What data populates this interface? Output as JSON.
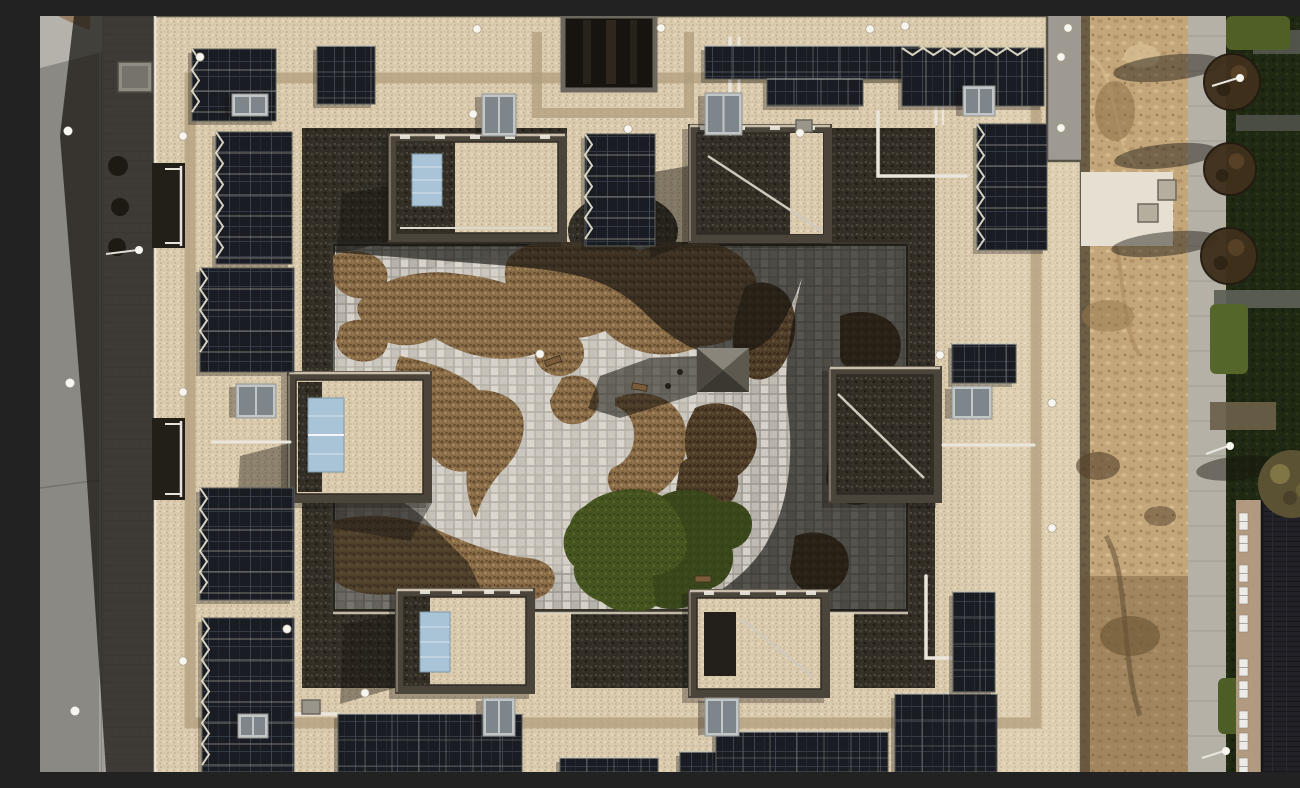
{
  "meta": {
    "title": "Aerial drone photograph — courtyard apartment block rooftop",
    "type": "top-down aerial photograph",
    "caption": "Top-down drone view of a large square courtyard apartment building: light gravel flat roof with many dark photovoltaic arrays, six stair/penthouse towers (some with light-blue solar-thermal collectors), skylights, white fall-protection anchors and pipework; landscaped inner courtyard with grey cobble paving, organic brown planting beds, a pyramid-roofed pavilion and a green turf patch; street with sidewalk on the left in building shadow; bare construction dirt strip, concrete pad, paver footpath, pruned trees, lawn with paved strips and a neighbouring dark pitched-roof house with white windows on the right."
  },
  "palette": {
    "road": "#8b8984",
    "sidewalk": "#a6a39d",
    "shadow": "#16140f",
    "facade": "#f0e9da",
    "roofGravel": "#dbcbae",
    "roofBright": "#f2e7cd",
    "walkway": "#b09e7e",
    "parapet": "#4a443a",
    "sedum": "#322e26",
    "panel": "#191c22",
    "panelLine": "#3c434e",
    "panelFrame": "#5a5c58",
    "skyFrame": "#c3c6c6",
    "skyGlass": "#7f868b",
    "collector": "#a9c4d6",
    "courtPaving": "#c9c5bd",
    "pavingGap": "#9d9991",
    "shrub": "#876a46",
    "shrubDark": "#4e3d28",
    "turf": "#46551f",
    "turfDark": "#303d16",
    "dirt": "#c3a67a",
    "dirtDark": "#97794e",
    "path": "#b6b1a7",
    "grassDark": "#1f2812",
    "grassLight": "#4f5f26",
    "treeBrown": "#3f301c",
    "roofTiles": "#222127",
    "wallTan": "#b19a80",
    "windowWhite": "#ecebe7",
    "pipe": "#eae6dc",
    "dot": "#f7f5ef",
    "pavilionLight": "#8a857a",
    "pavilionDark": "#3b3831",
    "concretePad": "#e7e0d2"
  },
  "scene": {
    "inventory": {
      "solar_pv_arrays": 18,
      "stair_towers": 6,
      "solar_thermal_collectors": 3,
      "skylights": 9,
      "roof_anchor_points": 20,
      "planting_beds": 16,
      "courtyard_pavilions": 1,
      "turf_patches": 1,
      "street_trees_right": 3,
      "street_lamps": 7,
      "neighbouring_buildings": 1,
      "balcony_recesses_left": 2
    },
    "anchor_dots": [
      [
        437,
        13
      ],
      [
        621,
        12
      ],
      [
        830,
        13
      ],
      [
        865,
        10
      ],
      [
        1028,
        12
      ],
      [
        160,
        41
      ],
      [
        1021,
        41
      ],
      [
        433,
        98
      ],
      [
        588,
        113
      ],
      [
        760,
        117
      ],
      [
        1021,
        112
      ],
      [
        900,
        339
      ],
      [
        1012,
        387
      ],
      [
        1012,
        512
      ],
      [
        143,
        376
      ],
      [
        143,
        120
      ],
      [
        143,
        645
      ],
      [
        247,
        613
      ],
      [
        325,
        677
      ],
      [
        500,
        338
      ]
    ],
    "skylights": [
      [
        192,
        78,
        36,
        22
      ],
      [
        442,
        78,
        34,
        42
      ],
      [
        665,
        77,
        37,
        42
      ],
      [
        923,
        70,
        32,
        30
      ],
      [
        196,
        368,
        40,
        34
      ],
      [
        912,
        370,
        40,
        33
      ],
      [
        443,
        682,
        32,
        38
      ],
      [
        665,
        682,
        34,
        38
      ],
      [
        198,
        698,
        30,
        24
      ]
    ],
    "solar_arrays": [
      [
        152,
        33,
        84,
        72,
        "tiltv"
      ],
      [
        277,
        30,
        58,
        58,
        "flat"
      ],
      [
        545,
        118,
        70,
        112,
        "tiltv"
      ],
      [
        665,
        30,
        214,
        33,
        "flat"
      ],
      [
        727,
        63,
        96,
        27,
        "flat"
      ],
      [
        862,
        32,
        142,
        58,
        "tilth"
      ],
      [
        937,
        108,
        70,
        126,
        "tiltv"
      ],
      [
        176,
        116,
        76,
        132,
        "tiltv"
      ],
      [
        160,
        252,
        94,
        104,
        "tiltv"
      ],
      [
        160,
        472,
        94,
        112,
        "tiltv"
      ],
      [
        162,
        602,
        92,
        154,
        "tiltv"
      ],
      [
        298,
        698,
        184,
        58,
        "flat"
      ],
      [
        640,
        736,
        102,
        20,
        "flat"
      ],
      [
        676,
        716,
        172,
        40,
        "flat"
      ],
      [
        855,
        678,
        102,
        78,
        "flat"
      ],
      [
        913,
        576,
        42,
        100,
        "flat"
      ],
      [
        912,
        328,
        64,
        39,
        "flat"
      ],
      [
        520,
        742,
        98,
        14,
        "flat"
      ]
    ],
    "towers": [
      [
        348,
        117,
        179,
        109,
        "mixed"
      ],
      [
        648,
        108,
        144,
        119,
        "sedum"
      ],
      [
        247,
        355,
        145,
        132,
        "gravel"
      ],
      [
        788,
        350,
        114,
        137,
        "sedum"
      ],
      [
        355,
        572,
        140,
        106,
        "gravel"
      ],
      [
        648,
        573,
        142,
        109,
        "gravel"
      ]
    ],
    "trees_right": [
      [
        1192,
        66,
        28
      ],
      [
        1190,
        153,
        26
      ],
      [
        1189,
        240,
        28
      ]
    ],
    "tree_shadows": [
      [
        1128,
        52,
        55,
        13
      ],
      [
        1126,
        140,
        52,
        12
      ],
      [
        1125,
        228,
        54,
        12
      ],
      [
        1198,
        452,
        42,
        12
      ]
    ],
    "windows_right_building_y": [
      497,
      519,
      549,
      571,
      599,
      643,
      665,
      695,
      717,
      742
    ],
    "paved_strips": [
      [
        1213,
        14,
        87,
        24,
        "#565850"
      ],
      [
        1196,
        99,
        104,
        16,
        "#4e5049"
      ],
      [
        1174,
        274,
        126,
        18,
        "#5d5f56"
      ],
      [
        1170,
        386,
        66,
        28,
        "#6b5f4a"
      ]
    ],
    "grass_patches": [
      [
        1186,
        0,
        64,
        34,
        "#4f5f26"
      ],
      [
        1170,
        288,
        38,
        70,
        "#55662a"
      ],
      [
        1178,
        662,
        56,
        56,
        "#4d5d26"
      ]
    ],
    "dirt_marks": [
      [
        1075,
        95,
        20,
        30,
        "#8d6f45",
        0.55
      ],
      [
        1068,
        300,
        26,
        16,
        "#96784c",
        0.5
      ],
      [
        1058,
        450,
        22,
        14,
        "#54402a",
        0.6
      ],
      [
        1090,
        620,
        30,
        20,
        "#6b5332",
        0.6
      ],
      [
        1102,
        40,
        18,
        12,
        "#d8c094",
        0.7
      ],
      [
        1120,
        500,
        16,
        10,
        "#55422c",
        0.5
      ]
    ]
  }
}
